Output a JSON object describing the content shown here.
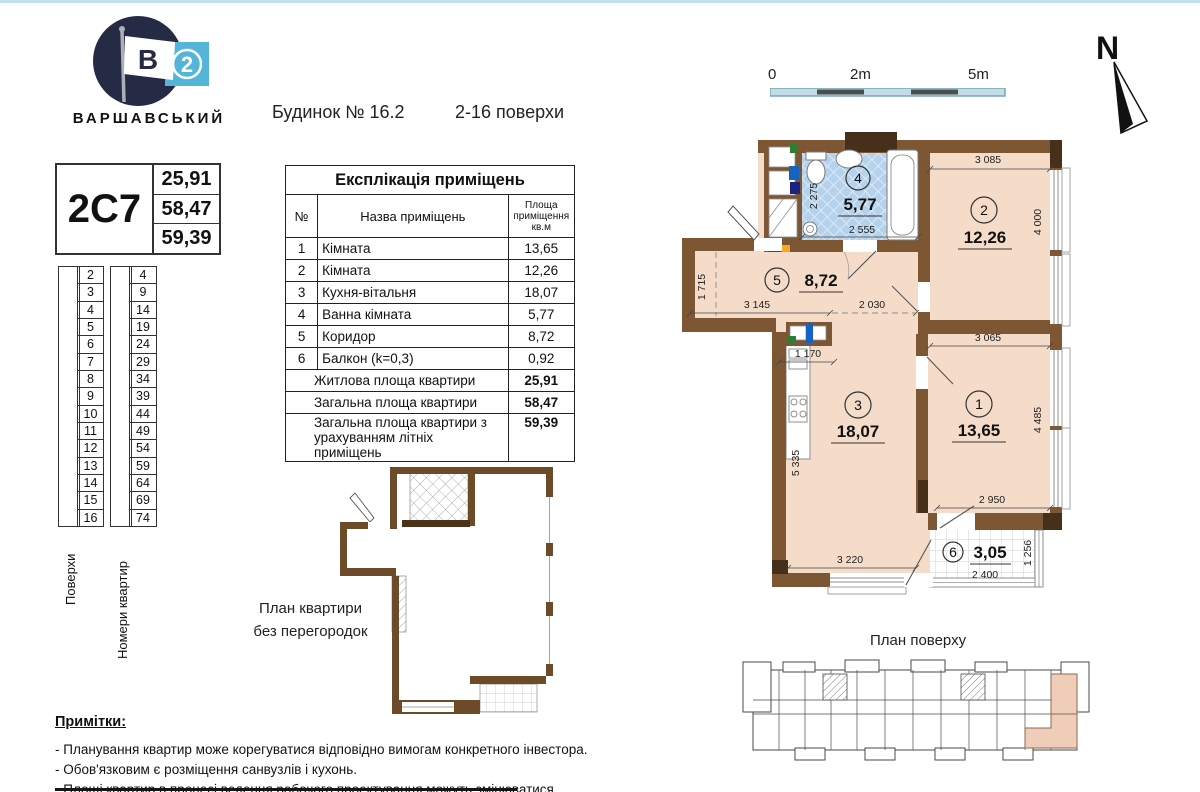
{
  "brand": {
    "name": "ВАРШАВСЬКИЙ",
    "flag_letter": "В",
    "flag_number": "2"
  },
  "header": {
    "building": "Будинок № 16.2",
    "floors_range": "2-16 поверхи"
  },
  "unit_card": {
    "code": "2С7",
    "living_area": "25,91",
    "total_area": "58,47",
    "total_area_summer": "59,39"
  },
  "floors_table": {
    "header": "Поверхи",
    "rows": [
      "2",
      "3",
      "4",
      "5",
      "6",
      "7",
      "8",
      "9",
      "10",
      "11",
      "12",
      "13",
      "14",
      "15",
      "16"
    ]
  },
  "apartments_table": {
    "header": "Номери квартир",
    "rows": [
      "4",
      "9",
      "14",
      "19",
      "24",
      "29",
      "34",
      "39",
      "44",
      "49",
      "54",
      "59",
      "64",
      "69",
      "74"
    ]
  },
  "explication": {
    "title": "Експлікація приміщень",
    "columns": {
      "num": "№",
      "name": "Назва приміщень",
      "area": "Площа приміщення кв.м"
    },
    "rows": [
      {
        "num": "1",
        "name": "Кімната",
        "area": "13,65"
      },
      {
        "num": "2",
        "name": "Кімната",
        "area": "12,26"
      },
      {
        "num": "3",
        "name": "Кухня-вітальня",
        "area": "18,07"
      },
      {
        "num": "4",
        "name": "Ванна кімната",
        "area": "5,77"
      },
      {
        "num": "5",
        "name": "Коридор",
        "area": "8,72"
      },
      {
        "num": "6",
        "name": "Балкон (k=0,3)",
        "area": "0,92"
      }
    ],
    "summary": [
      {
        "name": "Житлова площа квартири",
        "area": "25,91"
      },
      {
        "name": "Загальна площа квартири",
        "area": "58,47"
      },
      {
        "name": "Загальна площа квартири з урахуванням літніх приміщень",
        "area": "59,39"
      }
    ]
  },
  "scale_bar": {
    "labels": [
      "0",
      "2m",
      "5m"
    ]
  },
  "compass": {
    "label": "N"
  },
  "plan": {
    "rooms": [
      {
        "num": "1",
        "area": "13,65"
      },
      {
        "num": "2",
        "area": "12,26"
      },
      {
        "num": "3",
        "area": "18,07"
      },
      {
        "num": "4",
        "area": "5,77"
      },
      {
        "num": "5",
        "area": "8,72"
      },
      {
        "num": "6",
        "area": "3,05"
      }
    ],
    "dims": {
      "d3085": "3 085",
      "d4000": "4 000",
      "d3065": "3 065",
      "d4485": "4 485",
      "d2950": "2 950",
      "d1256": "1 256",
      "d2400": "2 400",
      "d3220": "3 220",
      "d5335": "5 335",
      "d1170": "1 170",
      "d3145": "3 145",
      "d2030": "2 030",
      "d1715": "1 715",
      "d2275": "2 275",
      "d2555": "2 555"
    },
    "colors": {
      "wall": "#7d5633",
      "room": "#f4dcc9",
      "bath": "#b5d2ec"
    }
  },
  "outline_plan": {
    "caption_line1": "План квартири",
    "caption_line2": "без перегородок"
  },
  "floor_plan_small": {
    "caption": "План поверху"
  },
  "notes": {
    "title": "Примітки:",
    "items": [
      "- Планування квартир може корегуватися відповідно вимогам конкретного інвестора.",
      "- Обов'язковим є розміщення санвузлів і кухонь.",
      "- Площі квартир в процесі ведення робочого проектування можуть змінюватися."
    ]
  }
}
